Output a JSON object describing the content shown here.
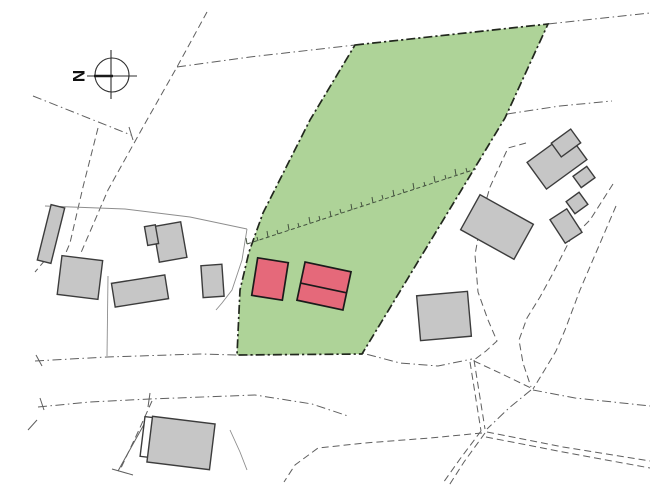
{
  "compass": {
    "label": "N"
  },
  "colors": {
    "background": "#ffffff",
    "parcel_fill": "#aed398",
    "parcel_border": "#22281e",
    "proposed_building_fill": "#e5697a",
    "proposed_building_border": "#1b1b1b",
    "existing_building_fill": "#c6c6c6",
    "existing_building_border": "#3c3c3c",
    "boundary_line": "#5f5f5f",
    "contour_line": "#8d8d8d",
    "hatch_line": "#44523f"
  },
  "features": {
    "north_arrow": "compass-north-arrow",
    "parcel": "highlighted-development-parcel",
    "proposed_buildings": "proposed-buildings-red",
    "existing_buildings": "existing-buildings-gray",
    "slope_hatching": "embankment-tick-line",
    "boundaries": "cadastral-boundary-dashed-lines",
    "roads": "road-centerlines-dash-dot"
  },
  "counts": {
    "proposed_buildings": 2,
    "existing_building_groups": 9
  }
}
